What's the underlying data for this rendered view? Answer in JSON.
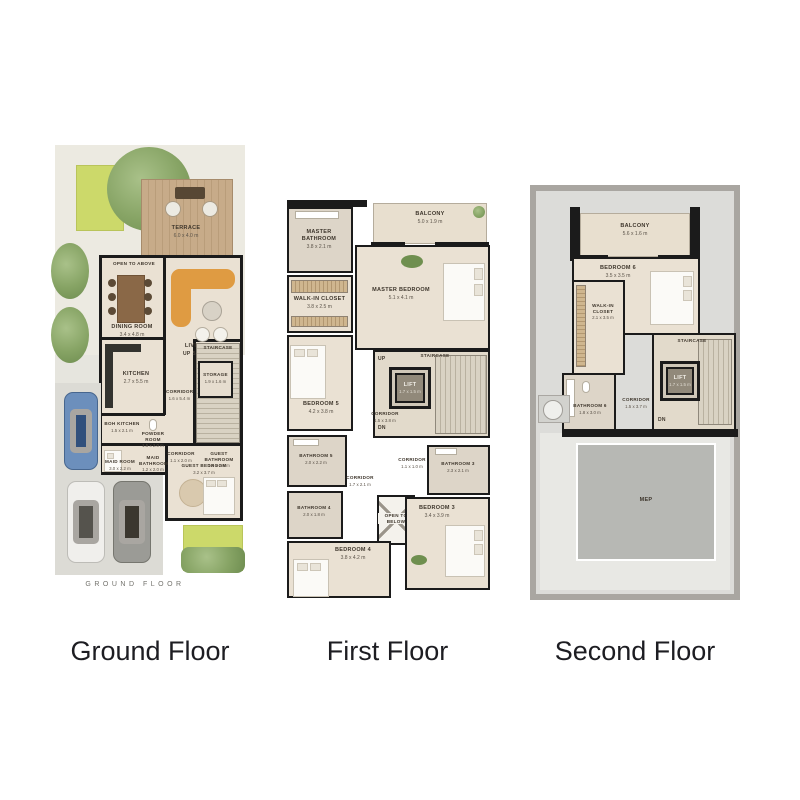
{
  "page": {
    "background": "#ffffff"
  },
  "captions": {
    "ground": "Ground Floor",
    "first": "First Floor",
    "second": "Second Floor"
  },
  "colors": {
    "wall": "#1b1b1b",
    "floor_beige": "#eae1d3",
    "bathroom_beige": "#ddd5c8",
    "terrace_wood": "#c2a47f",
    "lawn_green": "#ccd96a",
    "tree_green": "#86a268",
    "sofa_orange": "#df9b42",
    "roof_gray": "#dcdcd9",
    "mep_gray": "#b7b8b4",
    "driveway_gray": "#dcdbd5",
    "car_blue": "#6c8fbc"
  },
  "ground": {
    "plan_caption": "GROUND FLOOR",
    "rooms": {
      "terrace": {
        "name": "TERRACE",
        "dims": "6.0 x 4.0 m"
      },
      "open_to_above": {
        "name": "OPEN TO ABOVE"
      },
      "dining_room": {
        "name": "DINING ROOM",
        "dims": "3.4 x 4.8 m"
      },
      "living_room": {
        "name": "LIVING ROOM",
        "dims": "5.7 x 4.5 m"
      },
      "staircase": {
        "name": "STAIRCASE"
      },
      "up": {
        "name": "UP"
      },
      "storage": {
        "name": "STORAGE",
        "dims": "1.9 x 1.6 m"
      },
      "kitchen": {
        "name": "KITCHEN",
        "dims": "2.7 x 5.5 m"
      },
      "corridor": {
        "name": "CORRIDOR",
        "dims": "1.6 x 5.4 m"
      },
      "boh_kitchen": {
        "name": "BOH KITCHEN",
        "dims": "1.5 x 2.1 m"
      },
      "maid_room": {
        "name": "MAID ROOM",
        "dims": "3.0 x 2.2 m"
      },
      "maid_bathroom": {
        "name": "MAID BATHROOM",
        "dims": "1.2 x 2.0 m"
      },
      "powder_room": {
        "name": "POWDER ROOM",
        "dims": "1.5 x 2.0 m"
      },
      "guest_bathroom": {
        "name": "GUEST BATHROOM",
        "dims": "1.6 x 2.6 m"
      },
      "corridor_2": {
        "name": "CORRIDOR",
        "dims": "1.1 x 2.0 m"
      },
      "guest_bedroom": {
        "name": "GUEST BEDROOM",
        "dims": "3.2 x 3.7 m"
      },
      "entrance": {
        "name": "ENTRANCE"
      }
    }
  },
  "first": {
    "rooms": {
      "balcony": {
        "name": "BALCONY",
        "dims": "5.0 x 1.9 m"
      },
      "master_bathroom": {
        "name": "MASTER BATHROOM",
        "dims": "3.8 x 2.1 m"
      },
      "walk_in_closet": {
        "name": "WALK-IN CLOSET",
        "dims": "3.8 x 2.5 m"
      },
      "master_bedroom": {
        "name": "MASTER BEDROOM",
        "dims": "5.1 x 4.1 m"
      },
      "bedroom_5": {
        "name": "BEDROOM 5",
        "dims": "4.2 x 3.8 m"
      },
      "staircase": {
        "name": "STAIRCASE"
      },
      "lift": {
        "name": "LIFT",
        "dims": "1.7 x 1.5 m"
      },
      "corridor": {
        "name": "CORRIDOR",
        "dims": "1.5 x 3.8 m"
      },
      "up": {
        "name": "UP"
      },
      "dn": {
        "name": "DN"
      },
      "bathroom_5": {
        "name": "BATHROOM 5",
        "dims": "2.0 x 2.2 m"
      },
      "bathroom_4": {
        "name": "BATHROOM 4",
        "dims": "2.0 x 1.8 m"
      },
      "corridor_2": {
        "name": "CORRIDOR",
        "dims": "1.7 x 2.1 m"
      },
      "corridor_3": {
        "name": "CORRIDOR",
        "dims": "1.1 x 1.0 m"
      },
      "bathroom_3": {
        "name": "BATHROOM 3",
        "dims": "2.3 x 2.1 m"
      },
      "open_to_below": {
        "name": "OPEN TO BELOW"
      },
      "bedroom_4": {
        "name": "BEDROOM 4",
        "dims": "3.8 x 4.2 m"
      },
      "bedroom_3": {
        "name": "BEDROOM 3",
        "dims": "3.4 x 3.9 m"
      }
    }
  },
  "second": {
    "rooms": {
      "balcony": {
        "name": "BALCONY",
        "dims": "5.6 x 1.6 m"
      },
      "bedroom_6": {
        "name": "BEDROOM 6",
        "dims": "3.5 x 3.5 m"
      },
      "walk_in_closet": {
        "name": "WALK-IN CLOSET",
        "dims": "2.1 x 3.5 m"
      },
      "bathroom_6": {
        "name": "BATHROOM 6",
        "dims": "1.8 x 3.0 m"
      },
      "corridor": {
        "name": "CORRIDOR",
        "dims": "1.5 x 3.7 m"
      },
      "staircase": {
        "name": "STAIRCASE"
      },
      "lift": {
        "name": "LIFT",
        "dims": "1.7 x 1.5 m"
      },
      "dn": {
        "name": "DN"
      },
      "mep": {
        "name": "MEP"
      }
    }
  }
}
